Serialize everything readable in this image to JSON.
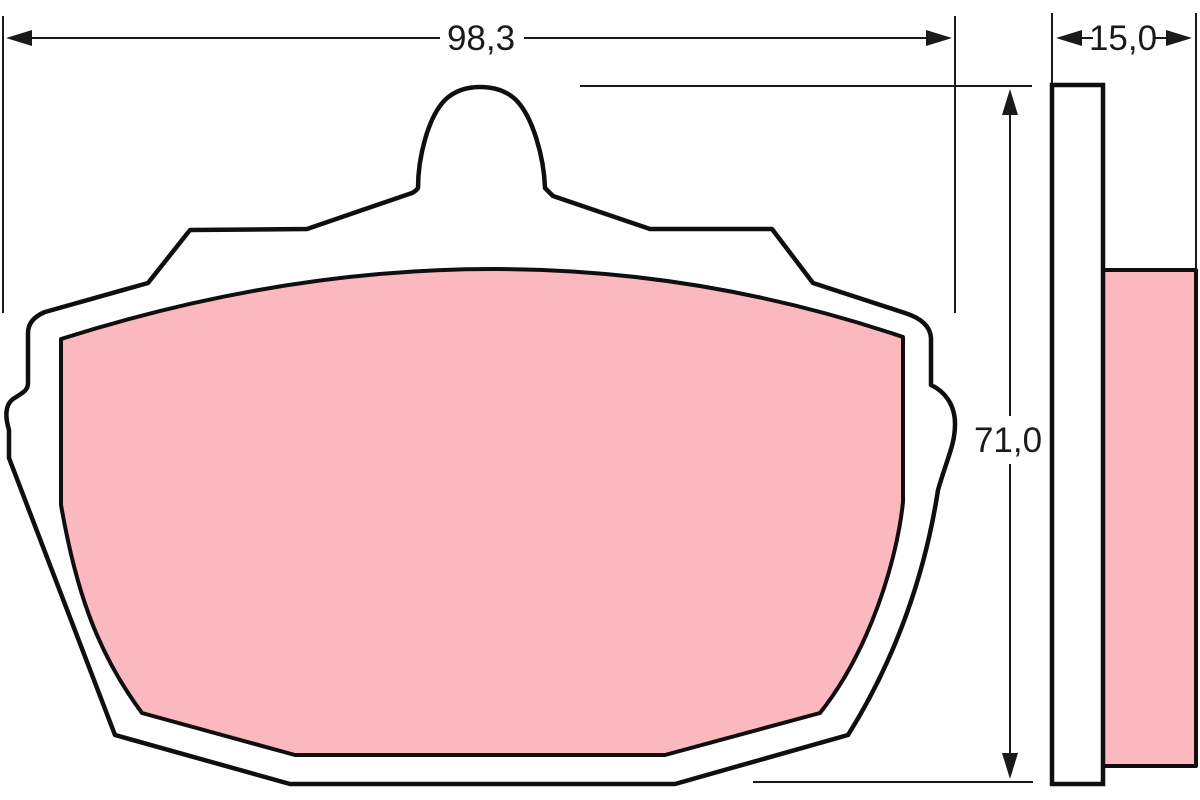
{
  "dimensions": {
    "width": {
      "value": "98,3"
    },
    "thickness": {
      "value": "15,0"
    },
    "height": {
      "value": "71,0"
    }
  },
  "colors": {
    "friction_material": "#fbb8be",
    "outline": "#0f0f0f",
    "dimension_lines": "#1a1a1a",
    "background": "#ffffff"
  }
}
